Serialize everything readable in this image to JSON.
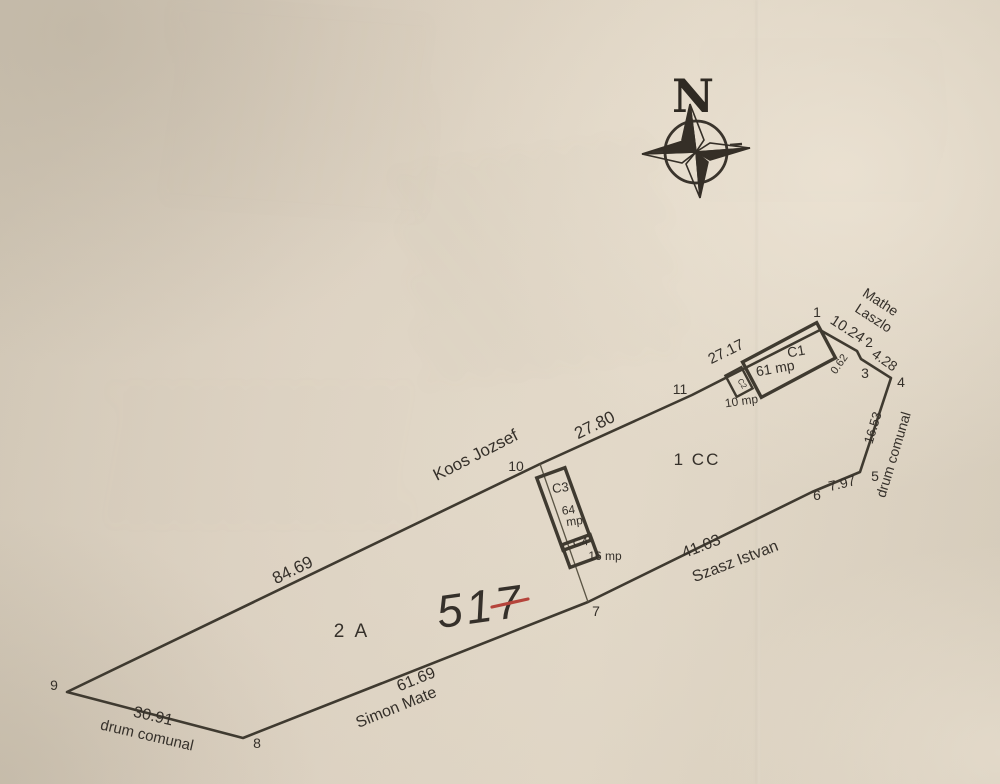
{
  "document_type": "cadastral-sketch",
  "compass": {
    "north_label": "N"
  },
  "map": {
    "ink_color": "#3f3a30",
    "text_color": "#35302a",
    "red_color": "#b5443b",
    "boundary": {
      "vertices": [
        {
          "n": "1",
          "x": 820,
          "y": 330,
          "label_x": 817,
          "label_y": 317
        },
        {
          "n": "2",
          "x": 857,
          "y": 351,
          "label_x": 869,
          "label_y": 347
        },
        {
          "n": "3",
          "x": 861,
          "y": 359,
          "label_x": 865,
          "label_y": 378
        },
        {
          "n": "4",
          "x": 891,
          "y": 378,
          "label_x": 901,
          "label_y": 387
        },
        {
          "n": "5",
          "x": 860,
          "y": 472,
          "label_x": 875,
          "label_y": 481
        },
        {
          "n": "6",
          "x": 812,
          "y": 492,
          "label_x": 817,
          "label_y": 500
        },
        {
          "n": "7",
          "x": 588,
          "y": 602,
          "label_x": 596,
          "label_y": 616
        },
        {
          "n": "8",
          "x": 243,
          "y": 738,
          "label_x": 257,
          "label_y": 748
        },
        {
          "n": "9",
          "x": 67,
          "y": 692,
          "label_x": 54,
          "label_y": 690
        },
        {
          "n": "10",
          "x": 540,
          "y": 464,
          "label_x": 516,
          "label_y": 471
        },
        {
          "n": "11",
          "x": 692,
          "y": 395,
          "label_x": 680,
          "label_y": 394
        }
      ]
    },
    "interior_lines": [
      {
        "from": "10",
        "to": "7",
        "coords": [
          540,
          464,
          588,
          602
        ]
      }
    ],
    "buildings": [
      {
        "id": "C1",
        "cx": 789,
        "cy": 360,
        "w": 84,
        "h": 40,
        "rot": -28,
        "id_label": {
          "text": "C1",
          "x": 797,
          "y": 356,
          "rot": -10,
          "size": 14
        },
        "area_label": {
          "text": "61 mp",
          "x": 776,
          "y": 373,
          "rot": -10,
          "size": 14
        }
      },
      {
        "id": "C2",
        "cx": 739,
        "cy": 382,
        "w": 18,
        "h": 24,
        "rot": -28,
        "id_label": {
          "text": "C2",
          "x": 740,
          "y": 385,
          "rot": 58,
          "size": 8
        },
        "area_label": {
          "text": "10 mp",
          "x": 742,
          "y": 405,
          "rot": -8,
          "size": 12
        }
      },
      {
        "id": "C3",
        "cx": 564,
        "cy": 509,
        "w": 30,
        "h": 77,
        "rot": -20,
        "id_label": {
          "text": "C3",
          "x": 561,
          "y": 492,
          "rot": -8,
          "size": 13
        },
        "area_label": {
          "text": "64",
          "x": 569,
          "y": 514,
          "rot": -8,
          "size": 12
        },
        "area_label2": {
          "text": "mp",
          "x": 575,
          "y": 525,
          "rot": -8,
          "size": 12
        }
      },
      {
        "id": "C4",
        "cx": 580,
        "cy": 551,
        "w": 30,
        "h": 24,
        "rot": -20,
        "id_label": {
          "text": "C4",
          "x": 581,
          "y": 546,
          "rot": -8,
          "size": 12
        },
        "area_label": {
          "text": "16 mp",
          "x": 605,
          "y": 560,
          "rot": 0,
          "size": 12
        }
      }
    ],
    "measurements": [
      {
        "text": "84.69",
        "x": 295,
        "y": 575,
        "rot": -26,
        "size": 17
      },
      {
        "text": "27.80",
        "x": 597,
        "y": 430,
        "rot": -26,
        "size": 17
      },
      {
        "text": "27.17",
        "x": 728,
        "y": 356,
        "rot": -26,
        "size": 15
      },
      {
        "text": "10.24",
        "x": 845,
        "y": 333,
        "rot": 33,
        "size": 15
      },
      {
        "text": "4.28",
        "x": 882,
        "y": 364,
        "rot": 35,
        "size": 14
      },
      {
        "text": "0.62",
        "x": 842,
        "y": 366,
        "rot": -55,
        "size": 11
      },
      {
        "text": "16.53",
        "x": 877,
        "y": 429,
        "rot": -73,
        "size": 13
      },
      {
        "text": "7.97",
        "x": 843,
        "y": 488,
        "rot": -13,
        "size": 14
      },
      {
        "text": "41.03",
        "x": 703,
        "y": 551,
        "rot": -21,
        "size": 16
      },
      {
        "text": "61.69",
        "x": 418,
        "y": 684,
        "rot": -22,
        "size": 16
      },
      {
        "text": "30.91",
        "x": 152,
        "y": 721,
        "rot": 13,
        "size": 16
      }
    ],
    "neighbors": [
      {
        "text": "Koos Jozsef",
        "x": 478,
        "y": 460,
        "rot": -27,
        "size": 17
      },
      {
        "text": "Mathe",
        "x": 878,
        "y": 306,
        "rot": 33,
        "size": 14
      },
      {
        "text": "Laszlo",
        "x": 871,
        "y": 322,
        "rot": 33,
        "size": 14
      },
      {
        "text": "drum comunal",
        "x": 898,
        "y": 456,
        "rot": -73,
        "size": 14
      },
      {
        "text": "Szasz Istvan",
        "x": 737,
        "y": 566,
        "rot": -21,
        "size": 16
      },
      {
        "text": "Simon Mate",
        "x": 398,
        "y": 712,
        "rot": -22,
        "size": 16
      },
      {
        "text": "drum comunal",
        "x": 146,
        "y": 740,
        "rot": 13,
        "size": 15
      }
    ],
    "zones": [
      {
        "text": "1 CC",
        "x": 697,
        "y": 465,
        "size": 17,
        "spacing": 2
      },
      {
        "text": "2 A",
        "x": 352,
        "y": 637,
        "size": 19,
        "spacing": 3
      }
    ],
    "parcel_number": {
      "text": "517",
      "x": 483,
      "y": 622,
      "rot": -8,
      "size": 46,
      "cross": [
        492,
        607,
        528,
        599
      ]
    }
  }
}
